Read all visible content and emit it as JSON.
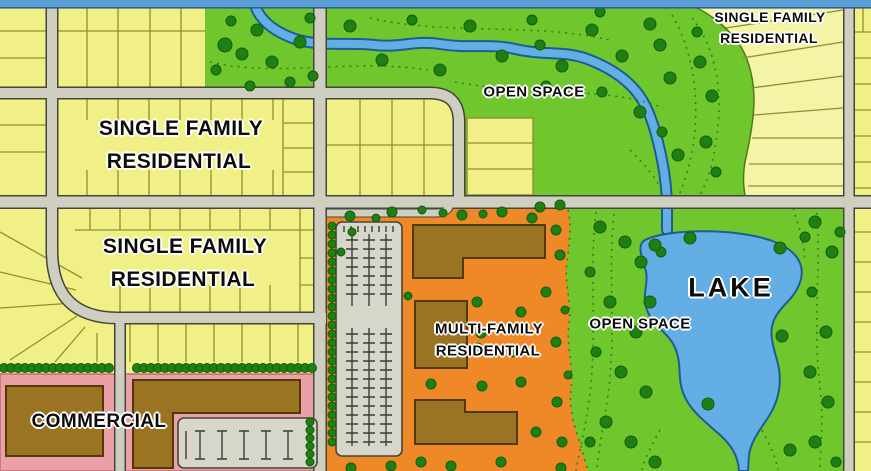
{
  "labels": {
    "sfr_top_right": {
      "line1": "SINGLE FAMILY",
      "line2": "RESIDENTIAL"
    },
    "sfr_upper": {
      "line1": "SINGLE FAMILY",
      "line2": "RESIDENTIAL"
    },
    "sfr_lower": {
      "line1": "SINGLE FAMILY",
      "line2": "RESIDENTIAL"
    },
    "open_space_top": "OPEN SPACE",
    "open_space_right": "OPEN SPACE",
    "multi_family": {
      "line1": "MULTI-FAMILY",
      "line2": "RESIDENTIAL"
    },
    "lake": "LAKE",
    "commercial": "COMMERCIAL"
  },
  "colors": {
    "single_family_fill": "#f0f086",
    "single_family_fill_light": "#f4f4a6",
    "open_space_fill": "#6fc72d",
    "tree_fill": "#1e7f12",
    "tree_edge": "#135c0a",
    "multi_family_fill": "#ef8928",
    "commercial_fill": "#eb9fa7",
    "building_fill": "#9a7423",
    "building_edge": "#4f3a08",
    "water_fill": "#64aee6",
    "water_edge": "#1c5e93",
    "road_fill": "#cfcfc1",
    "road_edge": "#45453a",
    "parking_fill": "#d6d6cb",
    "lot_line": "#8f8f2e",
    "contour": "#2c7c10",
    "top_bar": "#5b9ed6",
    "top_bar_edge": "#2b5f94"
  }
}
